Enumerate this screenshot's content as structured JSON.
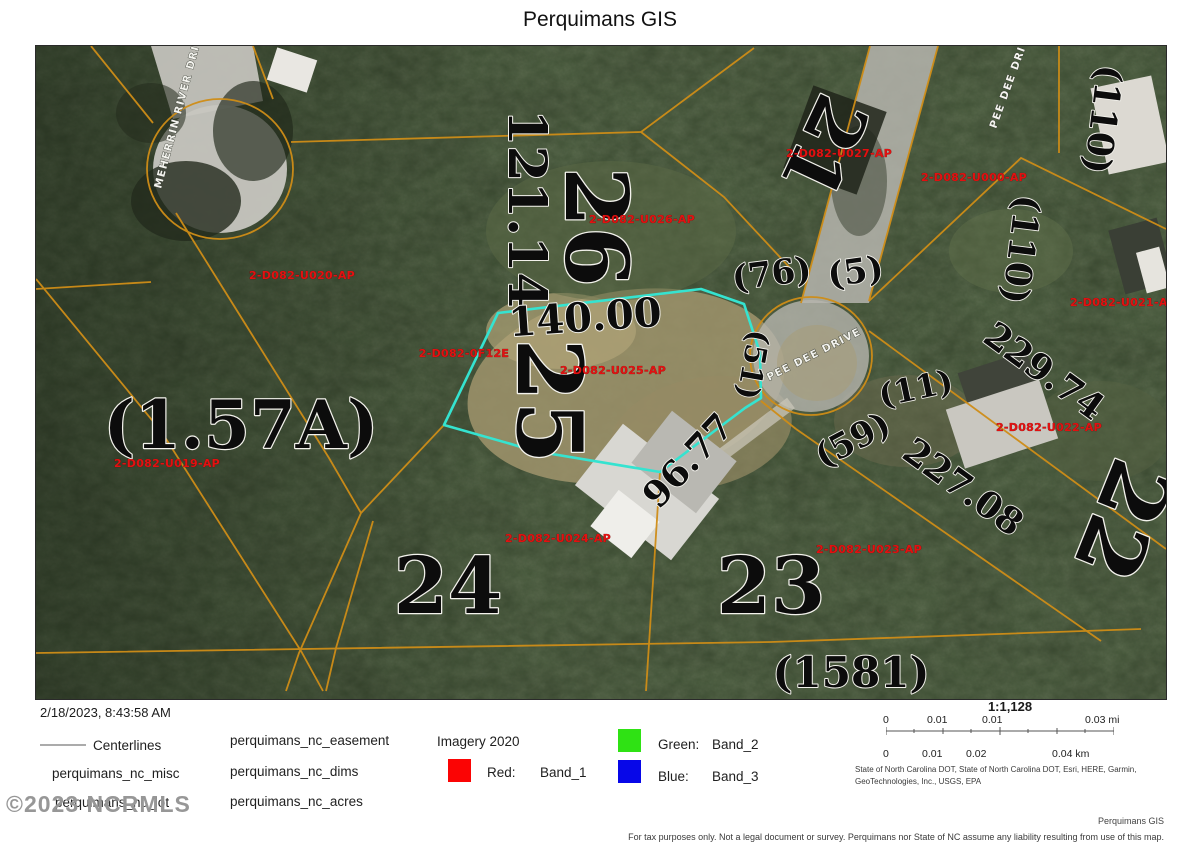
{
  "title": "Perquimans GIS",
  "map": {
    "streets": {
      "meherrin": "MEHERRIN RIVER DRIVE",
      "peedee_upper": "PEE DEE DRIVE",
      "peedee_circle": "PEE DEE DRIVE"
    },
    "lots": {
      "l21": "21",
      "l22": "22",
      "l23": "23",
      "l24": "24",
      "l25": "25",
      "l26": "26"
    },
    "acres": {
      "a157": "(1.57A)",
      "a110a": "(110)",
      "a110b": "(110)",
      "a76": "(76)",
      "a5": "(5)",
      "a51": "(51)",
      "a11": "(11)",
      "a59": "(59)",
      "a1581": "(1581)"
    },
    "dims": {
      "d121": "121.14",
      "d140": "140.00",
      "d96": "96.77",
      "d227": "227.08",
      "d229": "229.74"
    },
    "parcels": {
      "u019": "2-D082-U019-AP",
      "u020": "2-D082-U020-AP",
      "u021": "2-D082-U021-AP",
      "u022": "2-D082-U022-AP",
      "u023": "2-D082-U023-AP",
      "u024": "2-D082-U024-AP",
      "u025": "2-D082-U025-AP",
      "u026": "2-D082-U026-AP",
      "u027": "2-D082-U027-AP",
      "u000": "2-D082-U000-AP",
      "f12e": "2-D082-0F12E"
    },
    "highlight_color": "#35e3d0",
    "parcel_line_color": "#cf8d17"
  },
  "legend": {
    "timestamp": "2/18/2023, 8:43:58 AM",
    "centerlines": "Centerlines",
    "misc": "perquimans_nc_misc",
    "lot": "perquimans_nc_lot",
    "easement": "perquimans_nc_easement",
    "dims": "perquimans_nc_dims",
    "acres": "perquimans_nc_acres",
    "imagery": "Imagery 2020",
    "red_label": "Red:",
    "red_band": "Band_1",
    "green_label": "Green:",
    "green_band": "Band_2",
    "blue_label": "Blue:",
    "blue_band": "Band_3",
    "colors": {
      "red": "#fb0404",
      "green": "#2fe214",
      "blue": "#0707e8"
    }
  },
  "scale": {
    "ratio": "1:1,128",
    "mi": [
      "0",
      "0.01",
      "0.01",
      "0.03 mi"
    ],
    "km": [
      "0",
      "0.01",
      "0.02",
      "0.04 km"
    ],
    "attribution1": "State of North Carolina DOT, State of North Carolina DOT, Esri, HERE, Garmin,",
    "attribution2": "GeoTechnologies, Inc., USGS, EPA"
  },
  "footer": {
    "brand": "Perquimans GIS",
    "disclaimer": "For tax purposes only. Not a legal document or survey.  Perquimans nor State of NC assume any liability resulting from use of this map."
  },
  "watermark": "©2023 NCRMLS"
}
